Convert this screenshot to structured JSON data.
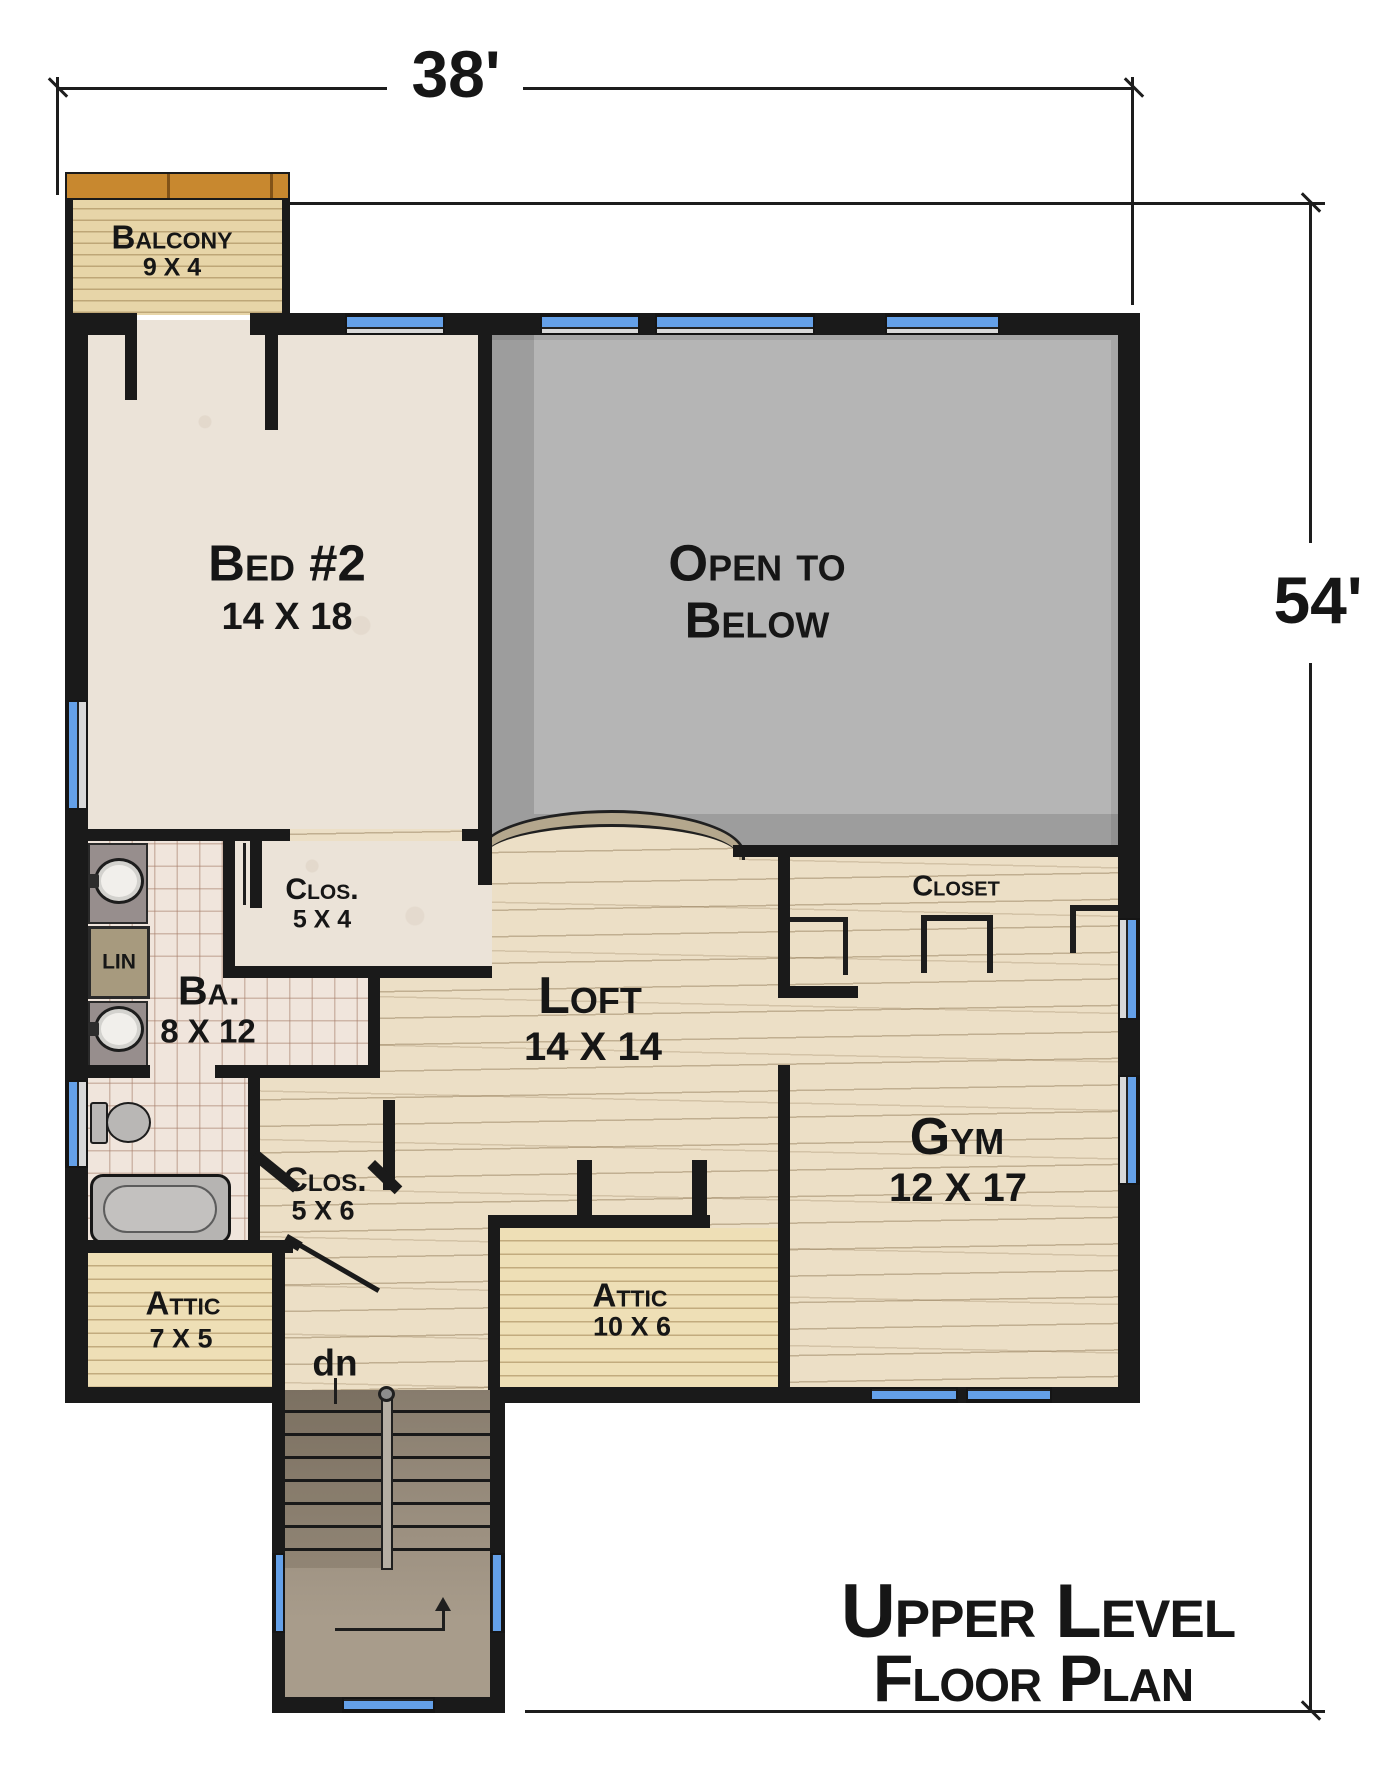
{
  "dimensions": {
    "width_label": "38'",
    "height_label": "54'"
  },
  "title": {
    "line1": "Upper Level",
    "line2": "Floor Plan"
  },
  "rooms": {
    "balcony": {
      "name": "Balcony",
      "size": "9 X 4"
    },
    "bed2": {
      "name": "Bed #2",
      "size": "14 X 18"
    },
    "open_below": {
      "line1": "Open to",
      "line2": "Below"
    },
    "clos54": {
      "name": "Clos.",
      "size": "5 X 4"
    },
    "linen": {
      "name": "LIN"
    },
    "bath": {
      "name": "Ba.",
      "size": "8 X 12"
    },
    "loft": {
      "name": "Loft",
      "size": "14 X 14"
    },
    "gym_closet": {
      "name": "Closet"
    },
    "gym": {
      "name": "Gym",
      "size": "12 X 17"
    },
    "clos56": {
      "name": "Clos.",
      "size": "5 X 6"
    },
    "attic_small": {
      "name": "Attic",
      "size": "7 X 5"
    },
    "attic_mid": {
      "name": "Attic",
      "size": "10 X 6"
    },
    "stairs": {
      "down_label": "dn"
    }
  },
  "colors": {
    "wall": "#1a1a1a",
    "line": "#1d1d1d",
    "win": "#64a0e8",
    "carpet": "#ebe3d8",
    "tile": "#f0e5dc",
    "wood": "#ecdfc6",
    "attic": "#eedfb6",
    "balcony": "#e7d5a8",
    "balconytrim": "#c8882f",
    "openbelow": "#b5b5b5",
    "railcap": "#b4a78d"
  },
  "geometry": {
    "walls": [
      [
        65,
        313,
        60,
        22
      ],
      [
        250,
        313,
        95,
        22
      ],
      [
        445,
        313,
        95,
        22
      ],
      [
        640,
        313,
        15,
        22
      ],
      [
        815,
        313,
        70,
        22
      ],
      [
        1000,
        313,
        140,
        22
      ],
      [
        65,
        313,
        23,
        387
      ],
      [
        65,
        810,
        23,
        270
      ],
      [
        65,
        1168,
        23,
        222
      ],
      [
        1118,
        313,
        22,
        605
      ],
      [
        1118,
        1020,
        22,
        55
      ],
      [
        1118,
        1185,
        22,
        218
      ],
      [
        65,
        1387,
        220,
        16
      ],
      [
        490,
        1387,
        380,
        16
      ],
      [
        958,
        1387,
        8,
        16
      ],
      [
        1052,
        1387,
        88,
        16
      ],
      [
        65,
        198,
        8,
        117
      ],
      [
        282,
        198,
        8,
        117
      ],
      [
        272,
        1403,
        13,
        310
      ],
      [
        490,
        1403,
        15,
        310
      ],
      [
        272,
        1697,
        70,
        16
      ],
      [
        435,
        1697,
        70,
        16
      ],
      [
        125,
        313,
        12,
        87
      ],
      [
        265,
        335,
        13,
        95
      ],
      [
        478,
        335,
        14,
        550
      ],
      [
        88,
        829,
        202,
        12
      ],
      [
        462,
        829,
        30,
        12
      ],
      [
        223,
        966,
        269,
        12
      ],
      [
        223,
        841,
        12,
        137
      ],
      [
        250,
        841,
        12,
        67
      ],
      [
        368,
        978,
        12,
        100
      ],
      [
        88,
        1065,
        62,
        13
      ],
      [
        215,
        1065,
        165,
        13
      ],
      [
        248,
        1078,
        12,
        172
      ],
      [
        65,
        1240,
        228,
        13
      ],
      [
        272,
        1240,
        13,
        163
      ],
      [
        488,
        1215,
        222,
        13
      ],
      [
        488,
        1228,
        12,
        162
      ],
      [
        577,
        1160,
        15,
        55
      ],
      [
        692,
        1160,
        15,
        55
      ],
      [
        778,
        857,
        12,
        136
      ],
      [
        778,
        1065,
        12,
        325
      ],
      [
        733,
        845,
        385,
        12
      ],
      [
        383,
        1100,
        12,
        90
      ],
      [
        778,
        986,
        80,
        12
      ]
    ],
    "angled": [
      [
        258,
        1150,
        54,
        11,
        39
      ],
      [
        375,
        1160,
        38,
        11,
        44
      ],
      [
        296,
        1240,
        97,
        5,
        30
      ],
      [
        288,
        1234,
        17,
        10,
        30
      ]
    ],
    "thin_lines": [
      [
        56,
        77,
        3,
        118
      ],
      [
        57,
        87,
        330,
        3
      ],
      [
        523,
        87,
        610,
        3
      ],
      [
        1131,
        77,
        3,
        228
      ],
      [
        290,
        202,
        1035,
        3
      ],
      [
        1309,
        203,
        3,
        340
      ],
      [
        1309,
        663,
        3,
        1048
      ],
      [
        525,
        1710,
        800,
        3
      ],
      [
        243,
        843,
        3,
        62
      ],
      [
        334,
        1378,
        3,
        26
      ],
      [
        335,
        1628,
        110,
        3
      ],
      [
        442,
        1610,
        3,
        20
      ],
      [
        790,
        917,
        58,
        5
      ],
      [
        843,
        917,
        5,
        58
      ],
      [
        921,
        915,
        72,
        6
      ],
      [
        921,
        915,
        6,
        58
      ],
      [
        987,
        915,
        6,
        58
      ],
      [
        1070,
        905,
        48,
        6
      ],
      [
        1070,
        905,
        6,
        48
      ]
    ],
    "ticks": [
      [
        45,
        86
      ],
      [
        1121,
        86
      ],
      [
        1298,
        201
      ],
      [
        1298,
        1709
      ]
    ],
    "win_top": [
      [
        345,
        313,
        100,
        22
      ],
      [
        540,
        313,
        100,
        22
      ],
      [
        655,
        313,
        160,
        22
      ],
      [
        885,
        313,
        115,
        22
      ]
    ],
    "win_bottom": [
      [
        870,
        1387,
        88,
        16
      ],
      [
        966,
        1387,
        86,
        16
      ],
      [
        342,
        1697,
        93,
        16
      ]
    ],
    "win_left": [
      [
        65,
        700,
        23,
        110
      ],
      [
        65,
        1080,
        23,
        88
      ],
      [
        272,
        1553,
        13,
        80
      ]
    ],
    "win_right": [
      [
        1118,
        918,
        22,
        102
      ],
      [
        1118,
        1075,
        22,
        110
      ],
      [
        490,
        1553,
        15,
        80
      ]
    ]
  }
}
